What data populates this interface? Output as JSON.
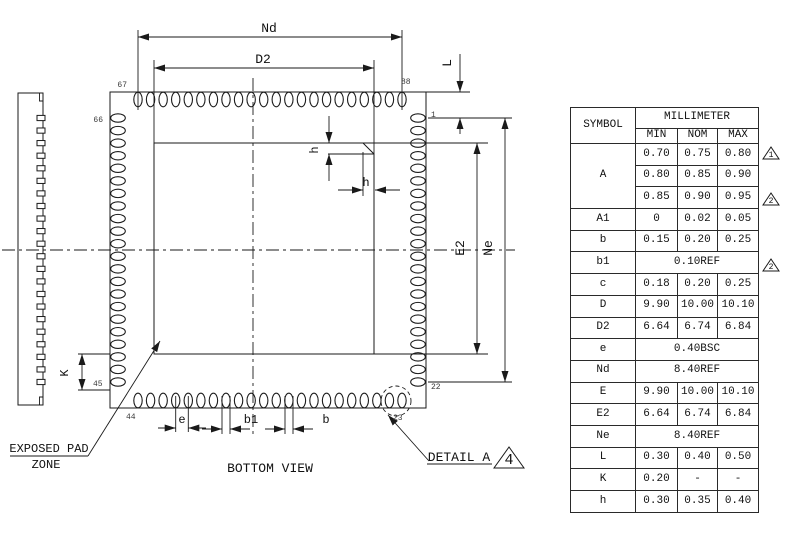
{
  "drawing": {
    "pins_per_side": 22,
    "labels": {
      "nd": "Nd",
      "d2": "D2",
      "l": "L",
      "h_vertical": "h",
      "h_horizontal": "h",
      "e2": "E2",
      "ne": "Ne",
      "k": "K",
      "e": "e",
      "b1": "b1",
      "b": "b"
    },
    "pin_labels": {
      "top_left": "67",
      "top_right": "88",
      "right_top": "1",
      "right_bottom": "22",
      "bottom_right": "23",
      "bottom_left": "44",
      "left_bottom": "45",
      "left_top": "66"
    },
    "captions": {
      "bottom_view": "BOTTOM VIEW",
      "exposed_pad_line1": "EXPOSED PAD",
      "exposed_pad_line2": "ZONE",
      "detail": "DETAIL A",
      "detail_number": "4"
    }
  },
  "table": {
    "header": {
      "symbol": "SYMBOL",
      "unit": "MILLIMETER",
      "min": "MIN",
      "nom": "NOM",
      "max": "MAX"
    },
    "rows": [
      {
        "symbol": "A",
        "values": [
          "0.70",
          "0.75",
          "0.80"
        ]
      },
      {
        "symbol": "A",
        "values": [
          "0.80",
          "0.85",
          "0.90"
        ]
      },
      {
        "symbol": "A",
        "values": [
          "0.85",
          "0.90",
          "0.95"
        ]
      },
      {
        "symbol": "A1",
        "values": [
          "0",
          "0.02",
          "0.05"
        ]
      },
      {
        "symbol": "b",
        "values": [
          "0.15",
          "0.20",
          "0.25"
        ]
      },
      {
        "symbol": "b1",
        "span": "0.10REF"
      },
      {
        "symbol": "c",
        "values": [
          "0.18",
          "0.20",
          "0.25"
        ]
      },
      {
        "symbol": "D",
        "values": [
          "9.90",
          "10.00",
          "10.10"
        ]
      },
      {
        "symbol": "D2",
        "values": [
          "6.64",
          "6.74",
          "6.84"
        ]
      },
      {
        "symbol": "e",
        "span": "0.40BSC"
      },
      {
        "symbol": "Nd",
        "span": "8.40REF"
      },
      {
        "symbol": "E",
        "values": [
          "9.90",
          "10.00",
          "10.10"
        ]
      },
      {
        "symbol": "E2",
        "values": [
          "6.64",
          "6.74",
          "6.84"
        ]
      },
      {
        "symbol": "Ne",
        "span": "8.40REF"
      },
      {
        "symbol": "L",
        "values": [
          "0.30",
          "0.40",
          "0.50"
        ]
      },
      {
        "symbol": "K",
        "values": [
          "0.20",
          "-",
          "-"
        ]
      },
      {
        "symbol": "h",
        "values": [
          "0.30",
          "0.35",
          "0.40"
        ]
      }
    ],
    "callouts": [
      {
        "label": "1"
      },
      {
        "label": "2"
      },
      {
        "label": "2"
      }
    ]
  },
  "colors": {
    "line": "#1a1a1a",
    "background": "#ffffff"
  }
}
